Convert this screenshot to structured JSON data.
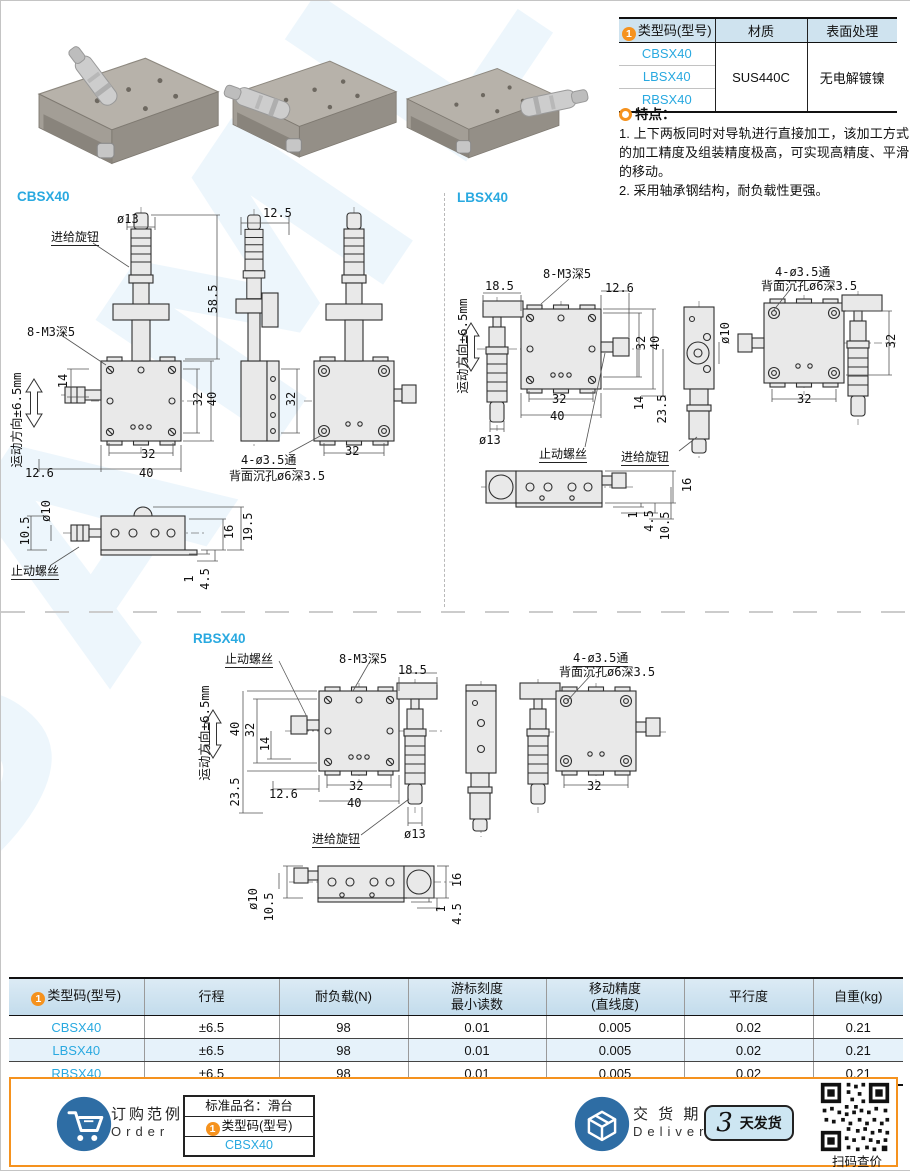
{
  "page": {
    "watermark": "SAMLB"
  },
  "shared": {
    "type_code": "类型码(型号)",
    "badge": "1"
  },
  "type_table": {
    "col_material": "材质",
    "col_surface": "表面处理",
    "models": [
      "CBSX40",
      "LBSX40",
      "RBSX40"
    ],
    "material": "SUS440C",
    "surface": "无电解镀镍"
  },
  "features": {
    "title": "特点：",
    "item1": "1. 上下两板同时对导轨进行直接加工，该加工方式的加工精度及组装精度极高，可实现高精度、平滑的移动。",
    "item2": "2. 采用轴承钢结构，耐负载性更强。"
  },
  "sections": {
    "s1": "CBSX40",
    "s2": "LBSX40",
    "s3": "RBSX40"
  },
  "dims": {
    "phi13": "ø13",
    "phi10": "ø10",
    "n1": "1",
    "n4_5": "4.5",
    "n10_5": "10.5",
    "n12_5": "12.5",
    "n12_6": "12.6",
    "n14": "14",
    "n16": "16",
    "n18_5": "18.5",
    "n19_5": "19.5",
    "n23_5": "23.5",
    "n32": "32",
    "n40": "40",
    "n58_5": "58.5",
    "motion": "运动方向±6.5mm",
    "knob": "进给旋钮",
    "stop": "止动螺丝",
    "thread": "8-M3深5",
    "thru": "4-ø3.5通",
    "cbore": "背面沉孔ø6深3.5"
  },
  "spec_table": {
    "headers": {
      "stroke": "行程",
      "load": "耐负载(N)",
      "vernier": "游标刻度\n最小读数",
      "accuracy": "移动精度\n(直线度)",
      "parallel": "平行度",
      "weight": "自重(kg)"
    },
    "rows": [
      {
        "model": "CBSX40",
        "stroke": "±6.5",
        "load": "98",
        "vernier": "0.01",
        "accuracy": "0.005",
        "parallel": "0.02",
        "weight": "0.21"
      },
      {
        "model": "LBSX40",
        "stroke": "±6.5",
        "load": "98",
        "vernier": "0.01",
        "accuracy": "0.005",
        "parallel": "0.02",
        "weight": "0.21"
      },
      {
        "model": "RBSX40",
        "stroke": "±6.5",
        "load": "98",
        "vernier": "0.01",
        "accuracy": "0.005",
        "parallel": "0.02",
        "weight": "0.21"
      }
    ]
  },
  "footer": {
    "order_cn": "订购范例",
    "order_en": "Order",
    "product_name": "标准品名：滑台",
    "example_model": "CBSX40",
    "delivery_cn": "交 货 期",
    "delivery_en": "Delivery",
    "delivery_days": "3",
    "delivery_unit": "天发货",
    "qr_caption": "扫码查价"
  }
}
